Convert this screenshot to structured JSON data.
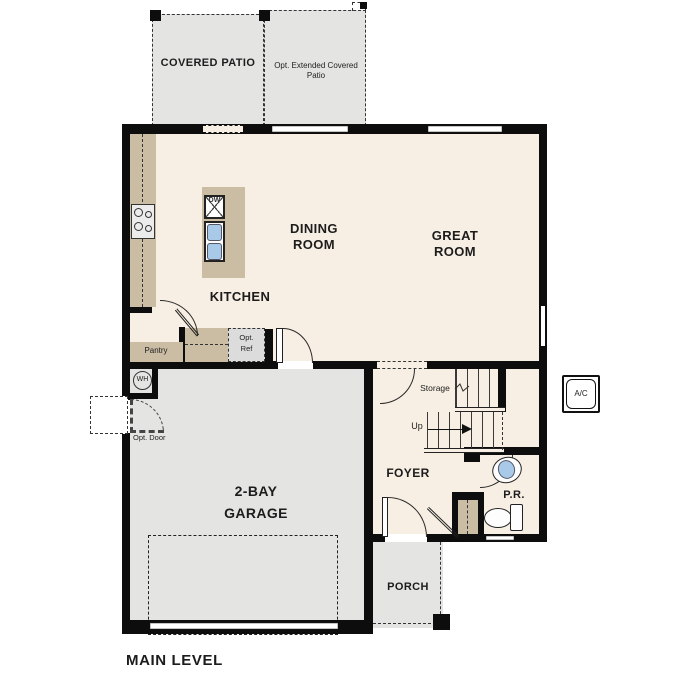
{
  "plan": {
    "level_title": "MAIN LEVEL",
    "rooms": {
      "covered_patio": "COVERED PATIO",
      "opt_extended_patio": "Opt. Extended Covered Patio",
      "dining_room": "DINING ROOM",
      "great_room": "GREAT ROOM",
      "kitchen": "KITCHEN",
      "pantry": "Pantry",
      "foyer": "FOYER",
      "powder_room": "P.R.",
      "garage": "2-BAY GARAGE",
      "porch": "PORCH",
      "storage": "Storage"
    },
    "annotations": {
      "stairs_direction": "Up",
      "opt_ref": "Opt. Ref",
      "opt_door": "Opt. Door",
      "dishwasher": "DW",
      "water_heater": "WH",
      "ac_unit": "A/C"
    },
    "colors": {
      "wall": "#0d0d0d",
      "floor": "#f7efe3",
      "ext": "#e4e4e2",
      "counter": "#cbbca4",
      "sink": "#a9c9e9",
      "appliance": "#dcdcdc"
    }
  }
}
